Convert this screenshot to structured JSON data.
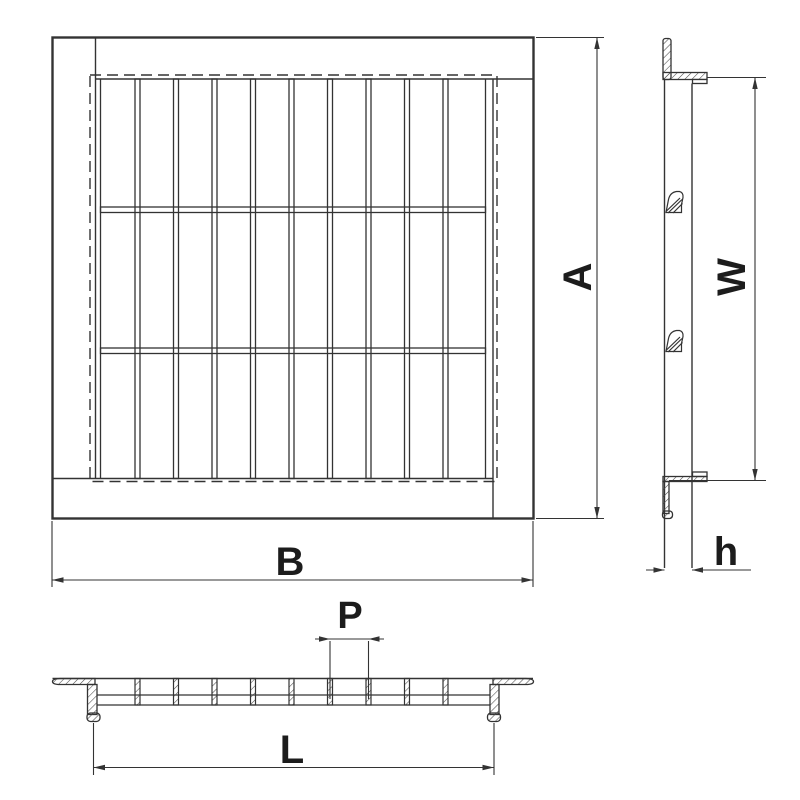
{
  "colors": {
    "background": "#ffffff",
    "line": "#333333",
    "text": "#1c1c1c"
  },
  "labels": {
    "plan_height": "A",
    "plan_width": "B",
    "side_height": "W",
    "side_thickness": "h",
    "bar_pitch": "P",
    "section_length": "L"
  }
}
